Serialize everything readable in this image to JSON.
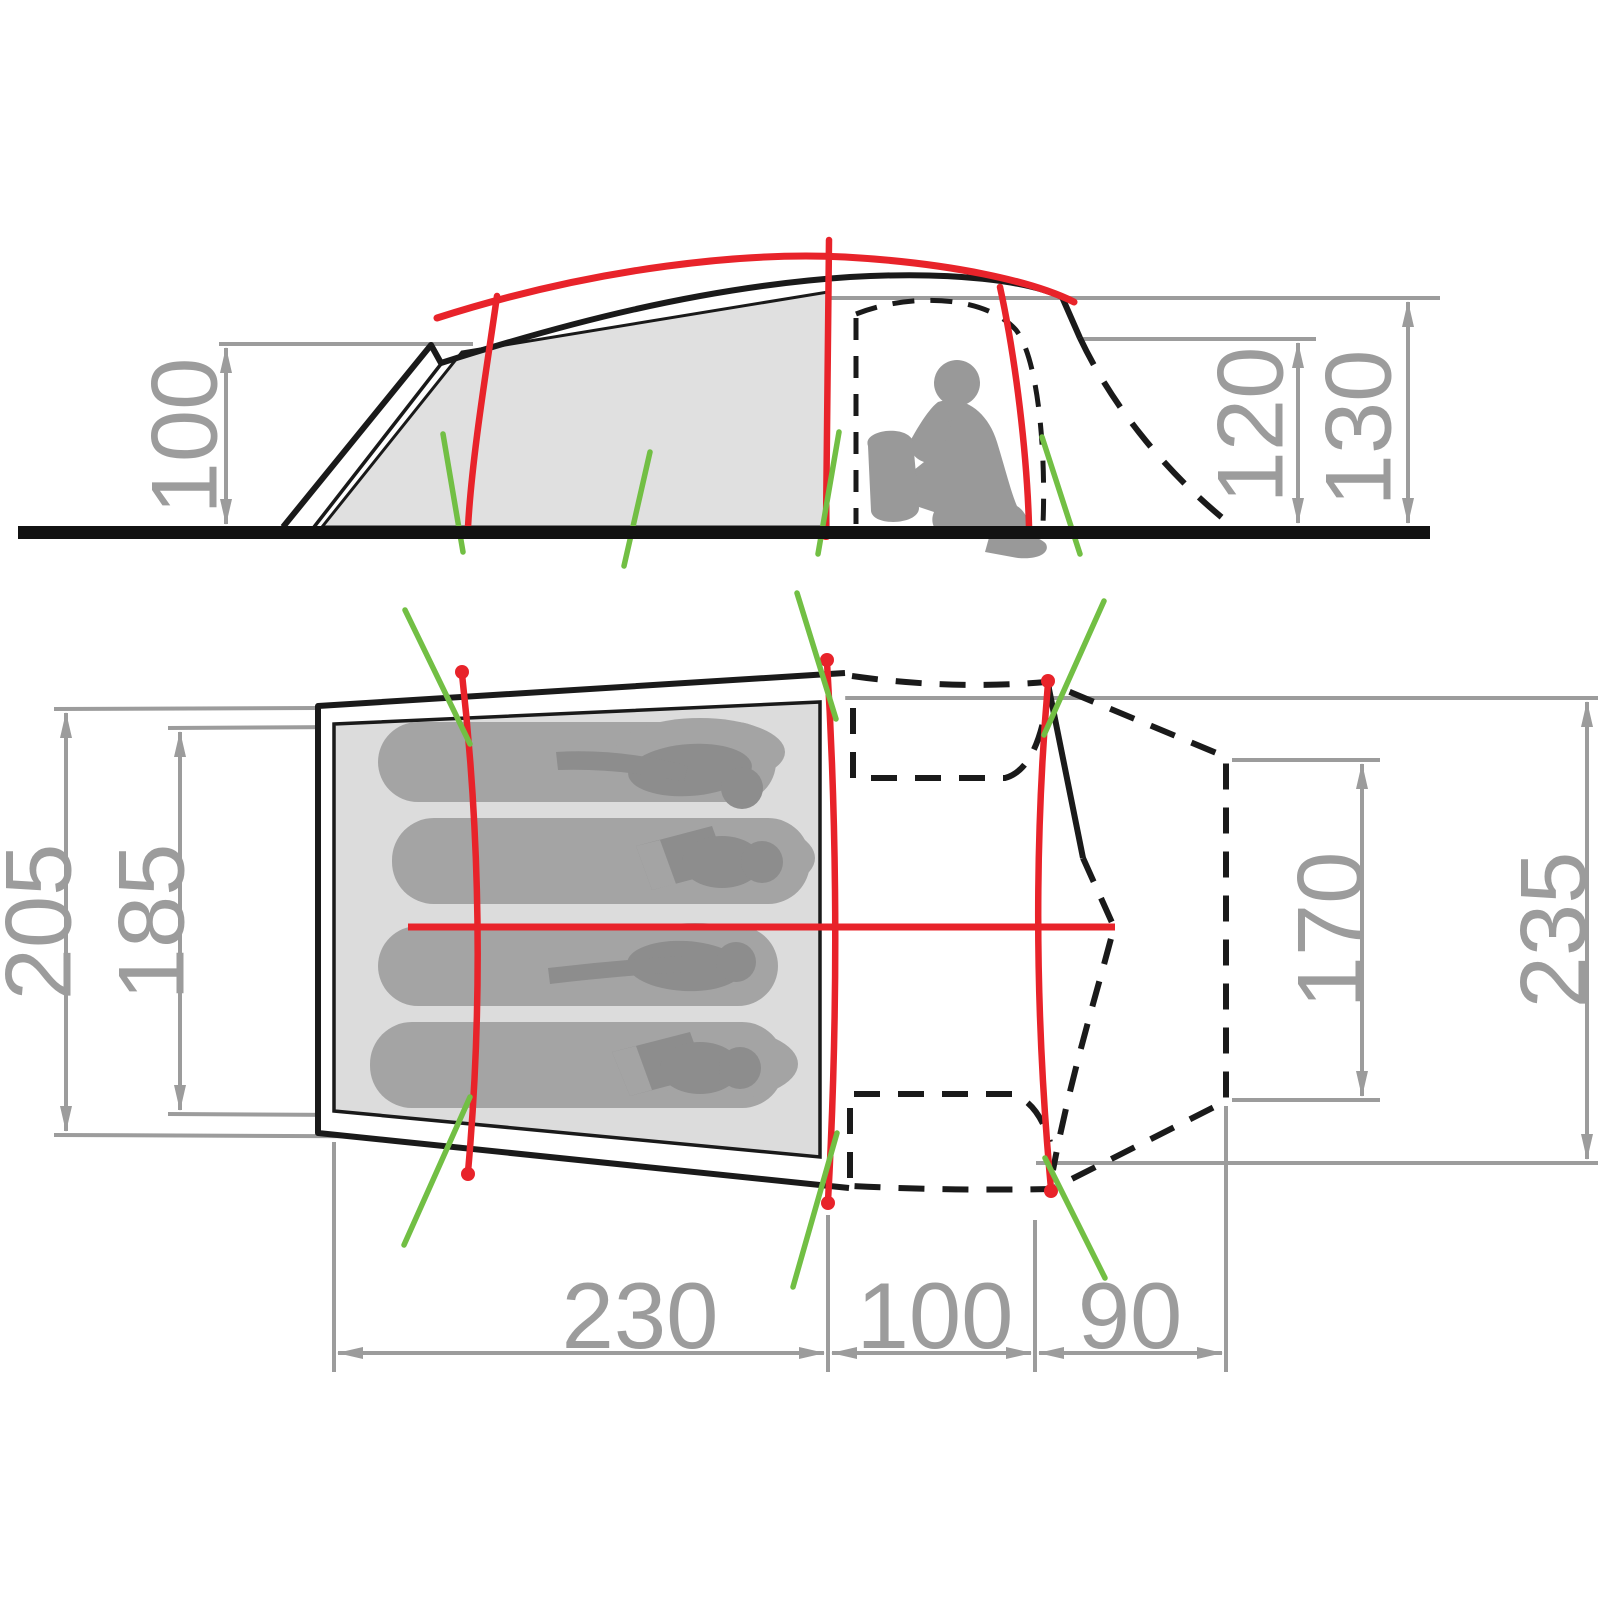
{
  "diagram": {
    "type": "tent-dimension-drawing",
    "views": [
      "side-elevation",
      "floor-plan"
    ],
    "units_implied": "cm",
    "occupant_silhouettes": 4
  },
  "side_view": {
    "dimensions": [
      {
        "id": "cabin-front-height",
        "label": "100"
      },
      {
        "id": "porch-rear-height",
        "label": "120"
      },
      {
        "id": "peak-height",
        "label": "130"
      }
    ]
  },
  "plan_view": {
    "dimensions": [
      {
        "id": "cabin-outer-width",
        "label": "205"
      },
      {
        "id": "sleeping-area-width",
        "label": "185"
      },
      {
        "id": "rear-panel-width",
        "label": "170"
      },
      {
        "id": "porch-max-width",
        "label": "235"
      },
      {
        "id": "sleeping-cabin-length",
        "label": "230"
      },
      {
        "id": "porch-length",
        "label": "100"
      },
      {
        "id": "rear-canopy-length",
        "label": "90"
      }
    ]
  },
  "colors": {
    "pole_red": "#e8232a",
    "guyline_green": "#72bf44",
    "dimension_gray": "#9c9c9c",
    "outline_black": "#1a1a1a",
    "inner_fabric_gray": "#dcdcdc",
    "silhouette_gray": "#999999",
    "sleeping_bag_gray": "#a4a4a4",
    "sleeper_body_gray": "#8d8d8d"
  }
}
